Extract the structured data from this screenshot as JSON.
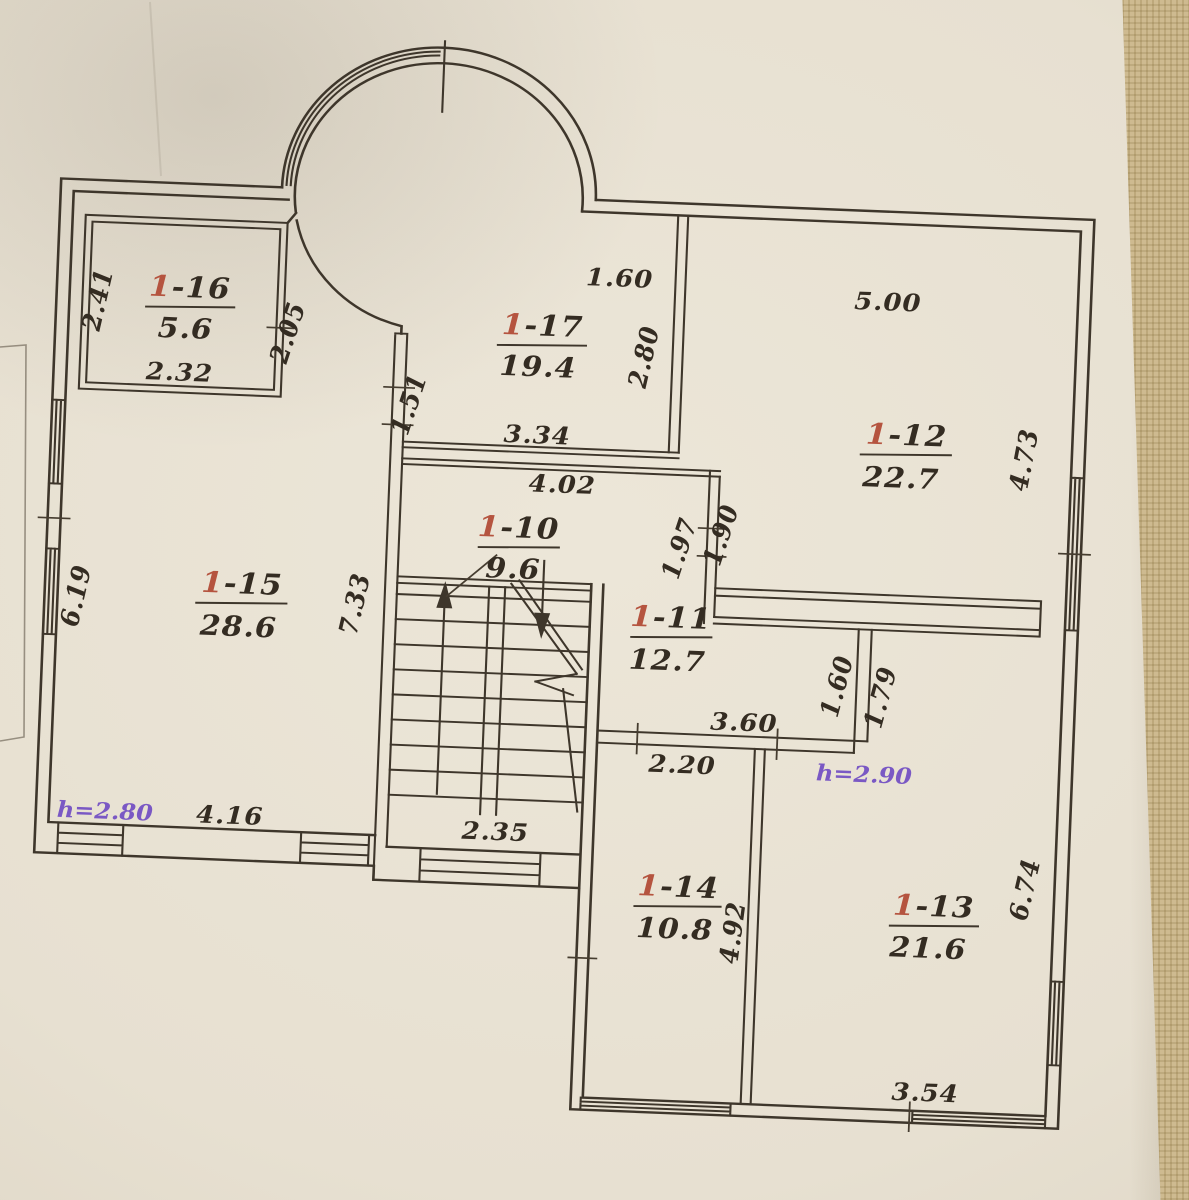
{
  "photo": {
    "surface_color": "#c8b488",
    "paper_color": "#e9e2d4",
    "ink_color": "#3e362b",
    "room_number_color": "#b5543f",
    "height_note_color": "#7a58c4"
  },
  "plan": {
    "rooms": [
      {
        "id": "1-16",
        "prefix": "1",
        "number": "-16",
        "area": "5.6"
      },
      {
        "id": "1-17",
        "prefix": "1",
        "number": "-17",
        "area": "19.4"
      },
      {
        "id": "1-12",
        "prefix": "1",
        "number": "-12",
        "area": "22.7"
      },
      {
        "id": "1-15",
        "prefix": "1",
        "number": "-15",
        "area": "28.6"
      },
      {
        "id": "1-10",
        "prefix": "1",
        "number": "-10",
        "area": "9.6"
      },
      {
        "id": "1-11",
        "prefix": "1",
        "number": "-11",
        "area": "12.7"
      },
      {
        "id": "1-14",
        "prefix": "1",
        "number": "-14",
        "area": "10.8"
      },
      {
        "id": "1-13",
        "prefix": "1",
        "number": "-13",
        "area": "21.6"
      }
    ],
    "dims": {
      "r16_left": "2.41",
      "r16_bottom": "2.32",
      "r16_door": "2.05",
      "r17_top": "1.60",
      "r17_right": "2.80",
      "r17_left": "1.51",
      "r17_bottom": "3.34",
      "hall_top": "4.02",
      "r12_top": "5.00",
      "r12_right": "4.73",
      "wall_197": "1.97",
      "wall_190": "1.90",
      "r15_left": "6.19",
      "r15_right": "7.33",
      "r15_bottom": "4.16",
      "r15_height": "h=2.80",
      "stair_bottom": "2.35",
      "r11_bottom": "3.60",
      "r14_top": "2.20",
      "r11_right": "1.60",
      "r13_left": "1.79",
      "r13_height": "h=2.90",
      "r14_right": "4.92",
      "r13_right": "6.74",
      "r13_bottom": "3.54"
    }
  }
}
